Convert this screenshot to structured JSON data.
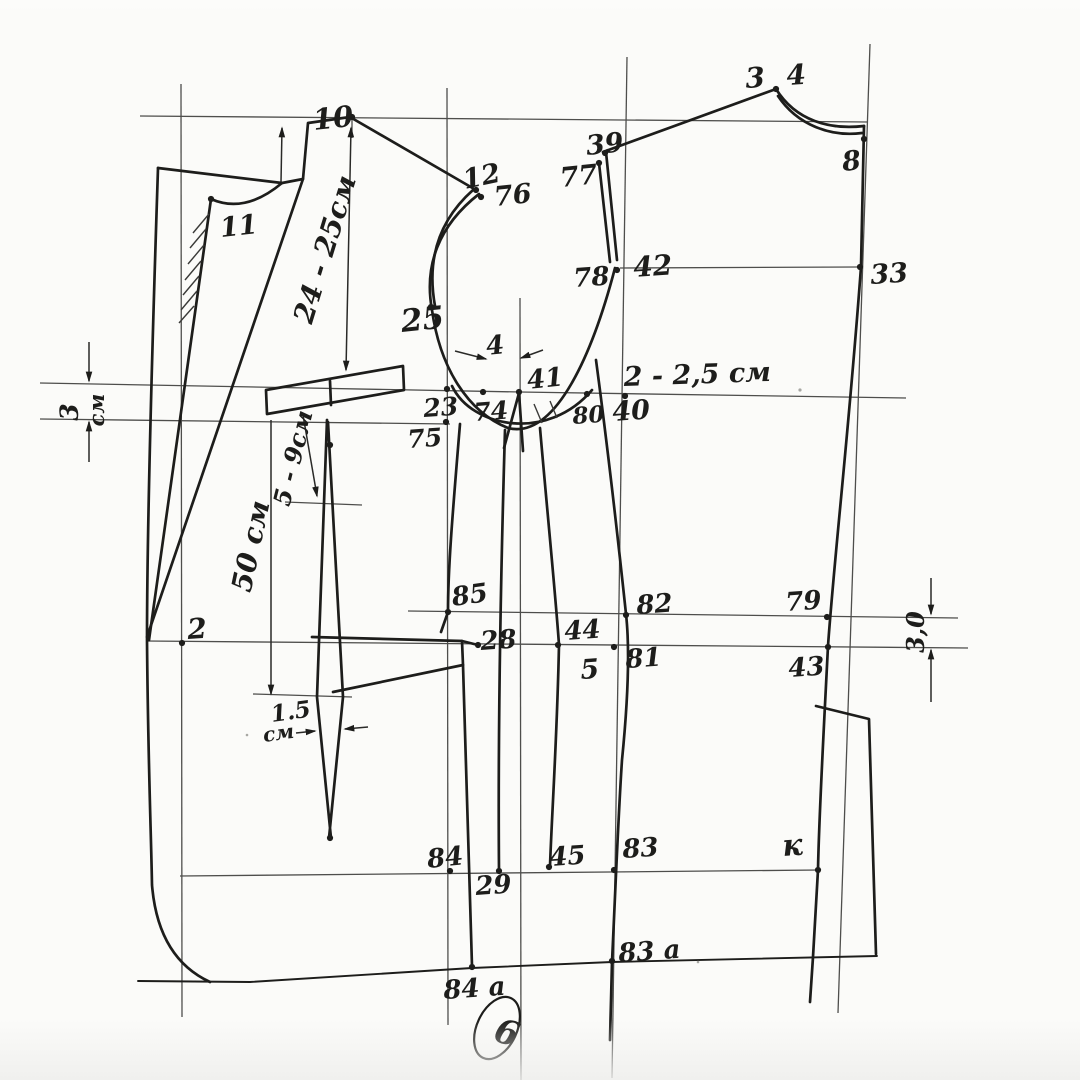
{
  "meta": {
    "description": "Hand-drawn garment (jacket) pattern drafting diagram, scanned sheet",
    "sheet_number": "6",
    "units": "см"
  },
  "colors": {
    "paper": "#fbfbf9",
    "ink": "#1d1d1b",
    "construction": "#4e4e4c",
    "speck": "#a8a8a4"
  },
  "labels": [
    {
      "id": "p10",
      "t": "10",
      "x": 314,
      "y": 130,
      "s": 29,
      "r": -6,
      "a": "start"
    },
    {
      "id": "p11",
      "t": "11",
      "x": 221,
      "y": 237,
      "s": 27,
      "r": -6,
      "a": "start"
    },
    {
      "id": "p12",
      "t": "12",
      "x": 465,
      "y": 189,
      "s": 27,
      "r": -12,
      "a": "start"
    },
    {
      "id": "p76",
      "t": "76",
      "x": 495,
      "y": 206,
      "s": 27,
      "r": -6,
      "a": "start"
    },
    {
      "id": "p25",
      "t": "25",
      "x": 402,
      "y": 332,
      "s": 31,
      "r": -6,
      "a": "start"
    },
    {
      "id": "p39",
      "t": "39",
      "x": 587,
      "y": 155,
      "s": 27,
      "r": -6,
      "a": "start"
    },
    {
      "id": "p77",
      "t": "77",
      "x": 561,
      "y": 187,
      "s": 27,
      "r": -6,
      "a": "start"
    },
    {
      "id": "p34",
      "t": "3 4",
      "x": 746,
      "y": 88,
      "s": 28,
      "r": -4,
      "a": "start"
    },
    {
      "id": "p8",
      "t": "8",
      "x": 843,
      "y": 171,
      "s": 27,
      "r": -6,
      "a": "start"
    },
    {
      "id": "p42",
      "t": "42",
      "x": 634,
      "y": 277,
      "s": 28,
      "r": -4,
      "a": "start"
    },
    {
      "id": "p78",
      "t": "78",
      "x": 574,
      "y": 287,
      "s": 26,
      "r": -4,
      "a": "start"
    },
    {
      "id": "p33",
      "t": "33",
      "x": 871,
      "y": 284,
      "s": 27,
      "r": -4,
      "a": "start"
    },
    {
      "id": "p23",
      "t": "23",
      "x": 424,
      "y": 417,
      "s": 25,
      "r": -4,
      "a": "start"
    },
    {
      "id": "p74",
      "t": "74",
      "x": 474,
      "y": 421,
      "s": 25,
      "r": -4,
      "a": "start"
    },
    {
      "id": "p41",
      "t": "41",
      "x": 528,
      "y": 389,
      "s": 26,
      "r": -6,
      "a": "start"
    },
    {
      "id": "p80",
      "t": "80",
      "x": 573,
      "y": 424,
      "s": 23,
      "r": -4,
      "a": "start"
    },
    {
      "id": "p40",
      "t": "40",
      "x": 613,
      "y": 421,
      "s": 27,
      "r": -4,
      "a": "start"
    },
    {
      "id": "p75",
      "t": "75",
      "x": 408,
      "y": 448,
      "s": 25,
      "r": -4,
      "a": "start"
    },
    {
      "id": "dim225",
      "t": "2 - 2,5 см",
      "x": 624,
      "y": 386,
      "s": 27,
      "r": -2,
      "a": "start"
    },
    {
      "id": "dim4",
      "t": "4",
      "x": 487,
      "y": 355,
      "s": 26,
      "r": -6,
      "a": "start"
    },
    {
      "id": "p2",
      "t": "2",
      "x": 188,
      "y": 639,
      "s": 28,
      "r": -4,
      "a": "start"
    },
    {
      "id": "p85",
      "t": "85",
      "x": 453,
      "y": 606,
      "s": 26,
      "r": -8,
      "a": "start"
    },
    {
      "id": "p28",
      "t": "28",
      "x": 481,
      "y": 650,
      "s": 26,
      "r": -4,
      "a": "start"
    },
    {
      "id": "p44",
      "t": "44",
      "x": 565,
      "y": 640,
      "s": 26,
      "r": -4,
      "a": "start"
    },
    {
      "id": "p5",
      "t": "5",
      "x": 581,
      "y": 679,
      "s": 27,
      "r": -4,
      "a": "start"
    },
    {
      "id": "p81",
      "t": "81",
      "x": 626,
      "y": 668,
      "s": 26,
      "r": -4,
      "a": "start"
    },
    {
      "id": "p82",
      "t": "82",
      "x": 637,
      "y": 614,
      "s": 26,
      "r": -4,
      "a": "start"
    },
    {
      "id": "p79",
      "t": "79",
      "x": 786,
      "y": 611,
      "s": 26,
      "r": -4,
      "a": "start"
    },
    {
      "id": "p43",
      "t": "43",
      "x": 789,
      "y": 677,
      "s": 26,
      "r": -4,
      "a": "start"
    },
    {
      "id": "p84",
      "t": "84",
      "x": 428,
      "y": 868,
      "s": 26,
      "r": -6,
      "a": "start"
    },
    {
      "id": "p29",
      "t": "29",
      "x": 476,
      "y": 895,
      "s": 26,
      "r": -4,
      "a": "start"
    },
    {
      "id": "p45",
      "t": "45",
      "x": 550,
      "y": 866,
      "s": 26,
      "r": -4,
      "a": "start"
    },
    {
      "id": "p83",
      "t": "83",
      "x": 623,
      "y": 858,
      "s": 26,
      "r": -4,
      "a": "start"
    },
    {
      "id": "pK",
      "t": "к",
      "x": 783,
      "y": 856,
      "s": 30,
      "r": -4,
      "a": "start"
    },
    {
      "id": "p83a",
      "t": "83 а",
      "x": 619,
      "y": 962,
      "s": 26,
      "r": -4,
      "a": "start"
    },
    {
      "id": "p84a",
      "t": "84 а",
      "x": 444,
      "y": 999,
      "s": 26,
      "r": -4,
      "a": "start"
    },
    {
      "id": "sheet6",
      "t": "6",
      "x": 492,
      "y": 1040,
      "s": 34,
      "r": 18,
      "a": "start"
    },
    {
      "id": "dim3L-num",
      "t": "3",
      "x": 78,
      "y": 412,
      "s": 25,
      "r": -90,
      "a": "middle"
    },
    {
      "id": "dim3L-unit",
      "t": "см",
      "x": 104,
      "y": 410,
      "s": 21,
      "r": -90,
      "a": "middle"
    },
    {
      "id": "dim30R",
      "t": "3,0",
      "x": 924,
      "y": 632,
      "s": 24,
      "r": -90,
      "a": "middle"
    },
    {
      "id": "dim15-num",
      "t": "1.5",
      "x": 272,
      "y": 722,
      "s": 23,
      "r": -8,
      "a": "start"
    },
    {
      "id": "dim15-unit",
      "t": "см",
      "x": 264,
      "y": 742,
      "s": 20,
      "r": -8,
      "a": "start"
    },
    {
      "id": "dim2425",
      "t": "24 - 25см",
      "x": 334,
      "y": 252,
      "s": 28,
      "r": -73,
      "a": "middle"
    },
    {
      "id": "dim50",
      "t": "50 см",
      "x": 260,
      "y": 548,
      "s": 28,
      "r": -78,
      "a": "middle"
    },
    {
      "id": "dim59",
      "t": "5 - 9см",
      "x": 301,
      "y": 460,
      "s": 24,
      "r": -76,
      "a": "middle"
    }
  ],
  "dots": [
    {
      "id": "10",
      "x": 352,
      "y": 117
    },
    {
      "id": "11",
      "x": 211,
      "y": 199
    },
    {
      "id": "12",
      "x": 476,
      "y": 190
    },
    {
      "id": "76",
      "x": 481,
      "y": 197
    },
    {
      "id": "25",
      "x": 431,
      "y": 307
    },
    {
      "id": "39",
      "x": 605,
      "y": 153
    },
    {
      "id": "77",
      "x": 599,
      "y": 163
    },
    {
      "id": "34",
      "x": 776,
      "y": 89
    },
    {
      "id": "8",
      "x": 864,
      "y": 139
    },
    {
      "id": "78",
      "x": 617,
      "y": 270
    },
    {
      "id": "33",
      "x": 860,
      "y": 267
    },
    {
      "id": "23",
      "x": 447,
      "y": 389
    },
    {
      "id": "74",
      "x": 483,
      "y": 392
    },
    {
      "id": "41",
      "x": 519,
      "y": 392
    },
    {
      "id": "80",
      "x": 587,
      "y": 394
    },
    {
      "id": "40",
      "x": 625,
      "y": 396
    },
    {
      "id": "75",
      "x": 446,
      "y": 422
    },
    {
      "id": "2",
      "x": 182,
      "y": 643
    },
    {
      "id": "85",
      "x": 448,
      "y": 612
    },
    {
      "id": "28",
      "x": 478,
      "y": 645
    },
    {
      "id": "44",
      "x": 558,
      "y": 645
    },
    {
      "id": "81",
      "x": 614,
      "y": 647
    },
    {
      "id": "82",
      "x": 626,
      "y": 615
    },
    {
      "id": "79",
      "x": 827,
      "y": 617
    },
    {
      "id": "43",
      "x": 828,
      "y": 647
    },
    {
      "id": "84",
      "x": 450,
      "y": 871
    },
    {
      "id": "45",
      "x": 549,
      "y": 867
    },
    {
      "id": "29",
      "x": 499,
      "y": 871
    },
    {
      "id": "83",
      "x": 614,
      "y": 870
    },
    {
      "id": "K",
      "x": 818,
      "y": 870
    },
    {
      "id": "83a",
      "x": 612,
      "y": 961
    },
    {
      "id": "84a",
      "x": 472,
      "y": 967
    },
    {
      "id": "dart-top",
      "x": 330,
      "y": 445
    },
    {
      "id": "dart-bottom",
      "x": 330,
      "y": 838
    }
  ]
}
